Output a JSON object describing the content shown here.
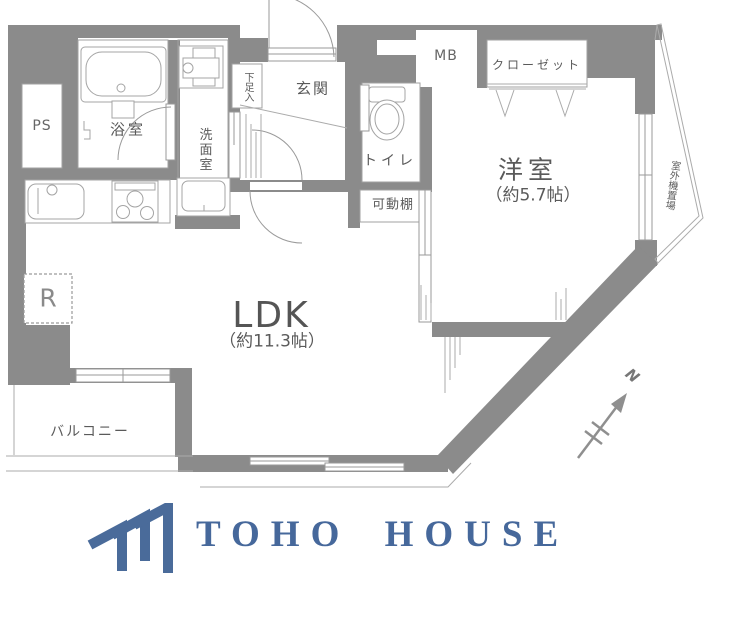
{
  "plan": {
    "rooms": {
      "ps": "PS",
      "bath": "浴室",
      "washroom": "洗面室",
      "shoe_box": "下足入",
      "entrance": "玄関",
      "mb": "MB",
      "closet": "クローゼット",
      "toilet": "トイレ",
      "movable_shelf": "可動棚",
      "western_room": "洋室",
      "western_room_size": "（約5.7帖）",
      "ldk": "LDK",
      "ldk_size": "（約11.3帖）",
      "balcony": "バルコニー",
      "outdoor_unit": "室外機置場",
      "refrigerator": "R",
      "north": "N"
    }
  },
  "logo": {
    "text": "TOHO HOUSE"
  },
  "colors": {
    "wall": "#8b8b8b",
    "logo_blue": "#46689b"
  }
}
